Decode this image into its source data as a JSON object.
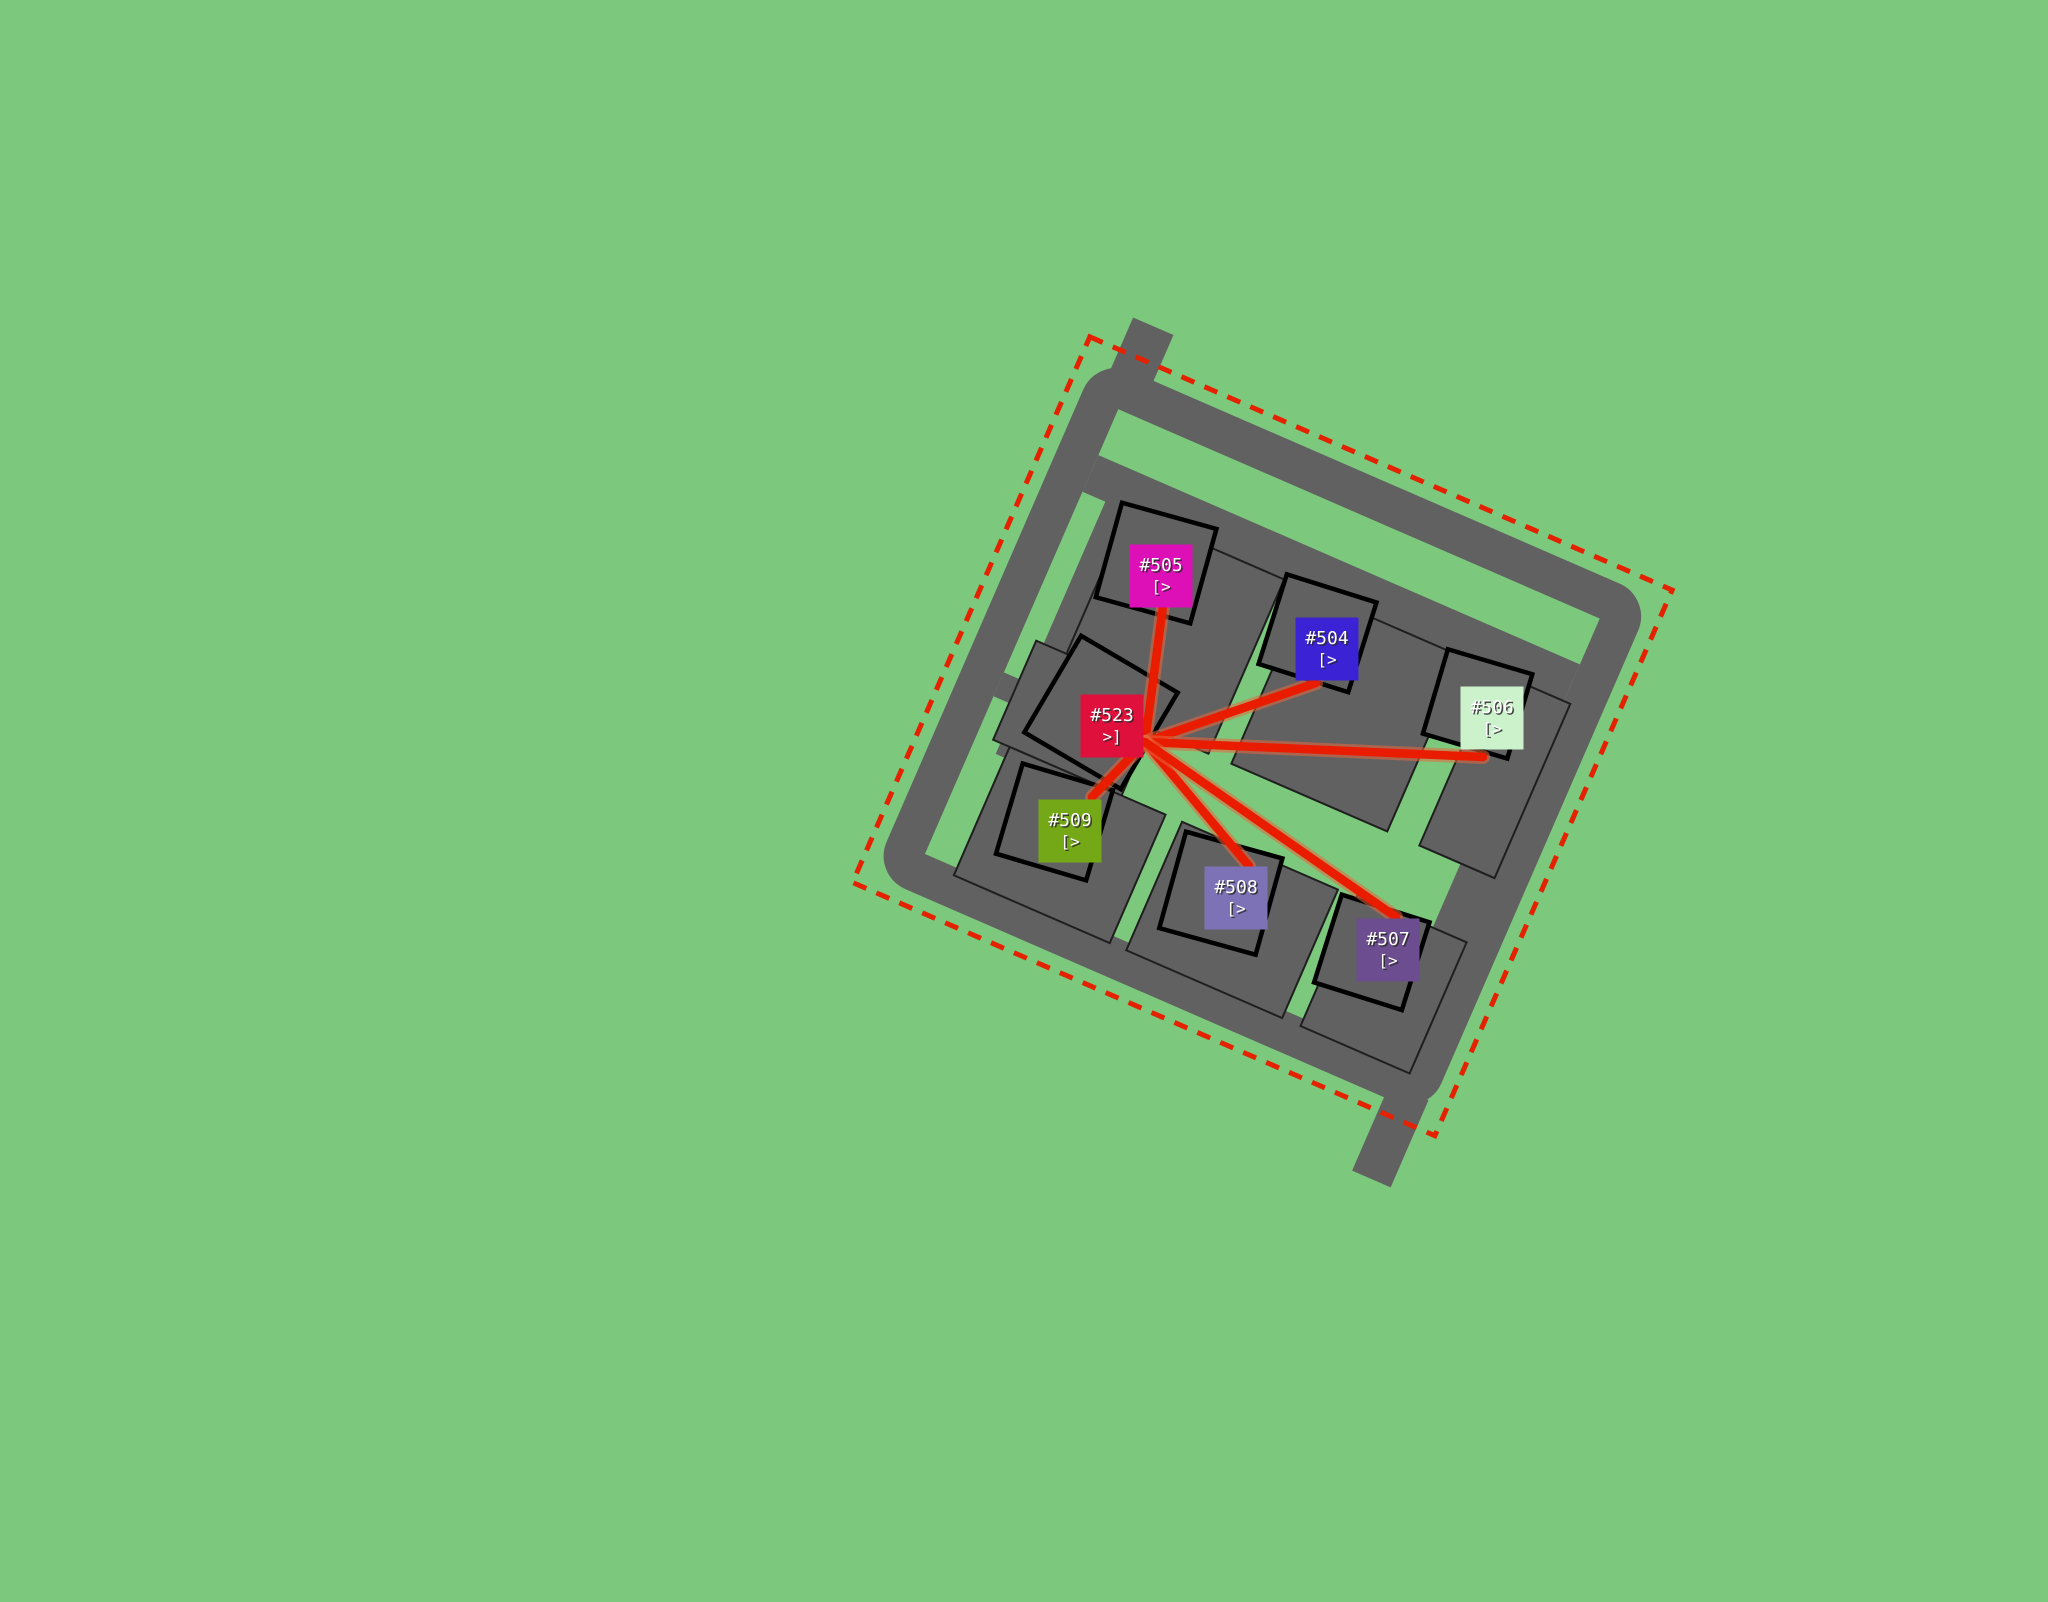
{
  "scene": {
    "description": "Aerial map view of a fenced residential block; red routes radiate from unit #523 to six other numbered units",
    "colors": {
      "background": "#7CC87C",
      "road": "#616161",
      "building_outline": "#000000",
      "boundary_dash": "#E42100",
      "route": "#EA1C00",
      "route_halo": "#E8673F",
      "label_text": "#FFFFFF"
    }
  },
  "map": {
    "hub_id": "#523",
    "marker_size": 63,
    "markers": [
      {
        "id": "#505",
        "flag": "[>",
        "color": "#DC10B6",
        "x": 1161,
        "y": 576
      },
      {
        "id": "#504",
        "flag": "[>",
        "color": "#3B22D4",
        "x": 1327,
        "y": 649
      },
      {
        "id": "#506",
        "flag": "[>",
        "color": "#CBF2CB",
        "x": 1492,
        "y": 718
      },
      {
        "id": "#523",
        "flag": ">]",
        "color": "#E0103C",
        "x": 1112,
        "y": 726
      },
      {
        "id": "#509",
        "flag": "[>",
        "color": "#74A816",
        "x": 1070,
        "y": 831
      },
      {
        "id": "#508",
        "flag": "[>",
        "color": "#7D72B6",
        "x": 1236,
        "y": 898
      },
      {
        "id": "#507",
        "flag": "[>",
        "color": "#6C4D8F",
        "x": 1388,
        "y": 950
      }
    ],
    "routes": {
      "origin": {
        "x": 1145,
        "y": 742
      },
      "targets": [
        {
          "id": "#505",
          "x": 1163,
          "y": 606
        },
        {
          "id": "#504",
          "x": 1316,
          "y": 683
        },
        {
          "id": "#506",
          "x": 1483,
          "y": 757
        },
        {
          "id": "#509",
          "x": 1092,
          "y": 797
        },
        {
          "id": "#508",
          "x": 1249,
          "y": 866
        },
        {
          "id": "#507",
          "x": 1396,
          "y": 917
        }
      ]
    }
  }
}
